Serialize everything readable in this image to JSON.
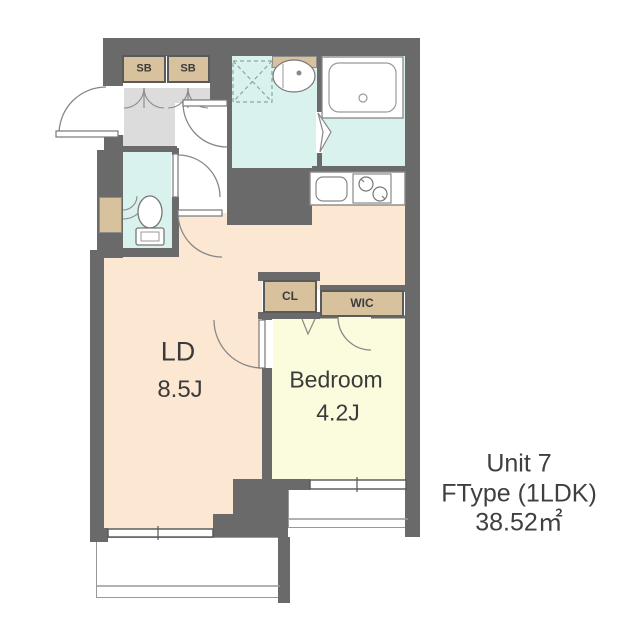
{
  "unit_info": {
    "name": "Unit 7",
    "type": "FType (1LDK)",
    "area": "38.52㎡"
  },
  "rooms": {
    "ld": {
      "name": "LD",
      "size": "8.5J"
    },
    "bedroom": {
      "name": "Bedroom",
      "size": "4.2J"
    }
  },
  "storage": {
    "sb1": "SB",
    "sb2": "SB",
    "cl": "CL",
    "wic": "WIC"
  },
  "colors": {
    "wall": "#6a6a6a",
    "ld_floor": "#fce7d3",
    "bedroom_floor": "#fbfbdd",
    "wet_area_floor": "#d9f2ee",
    "storage_fill": "#d8c29d",
    "entry_floor": "#dcdcdc",
    "line": "#888888",
    "text": "#3b3b3b"
  }
}
